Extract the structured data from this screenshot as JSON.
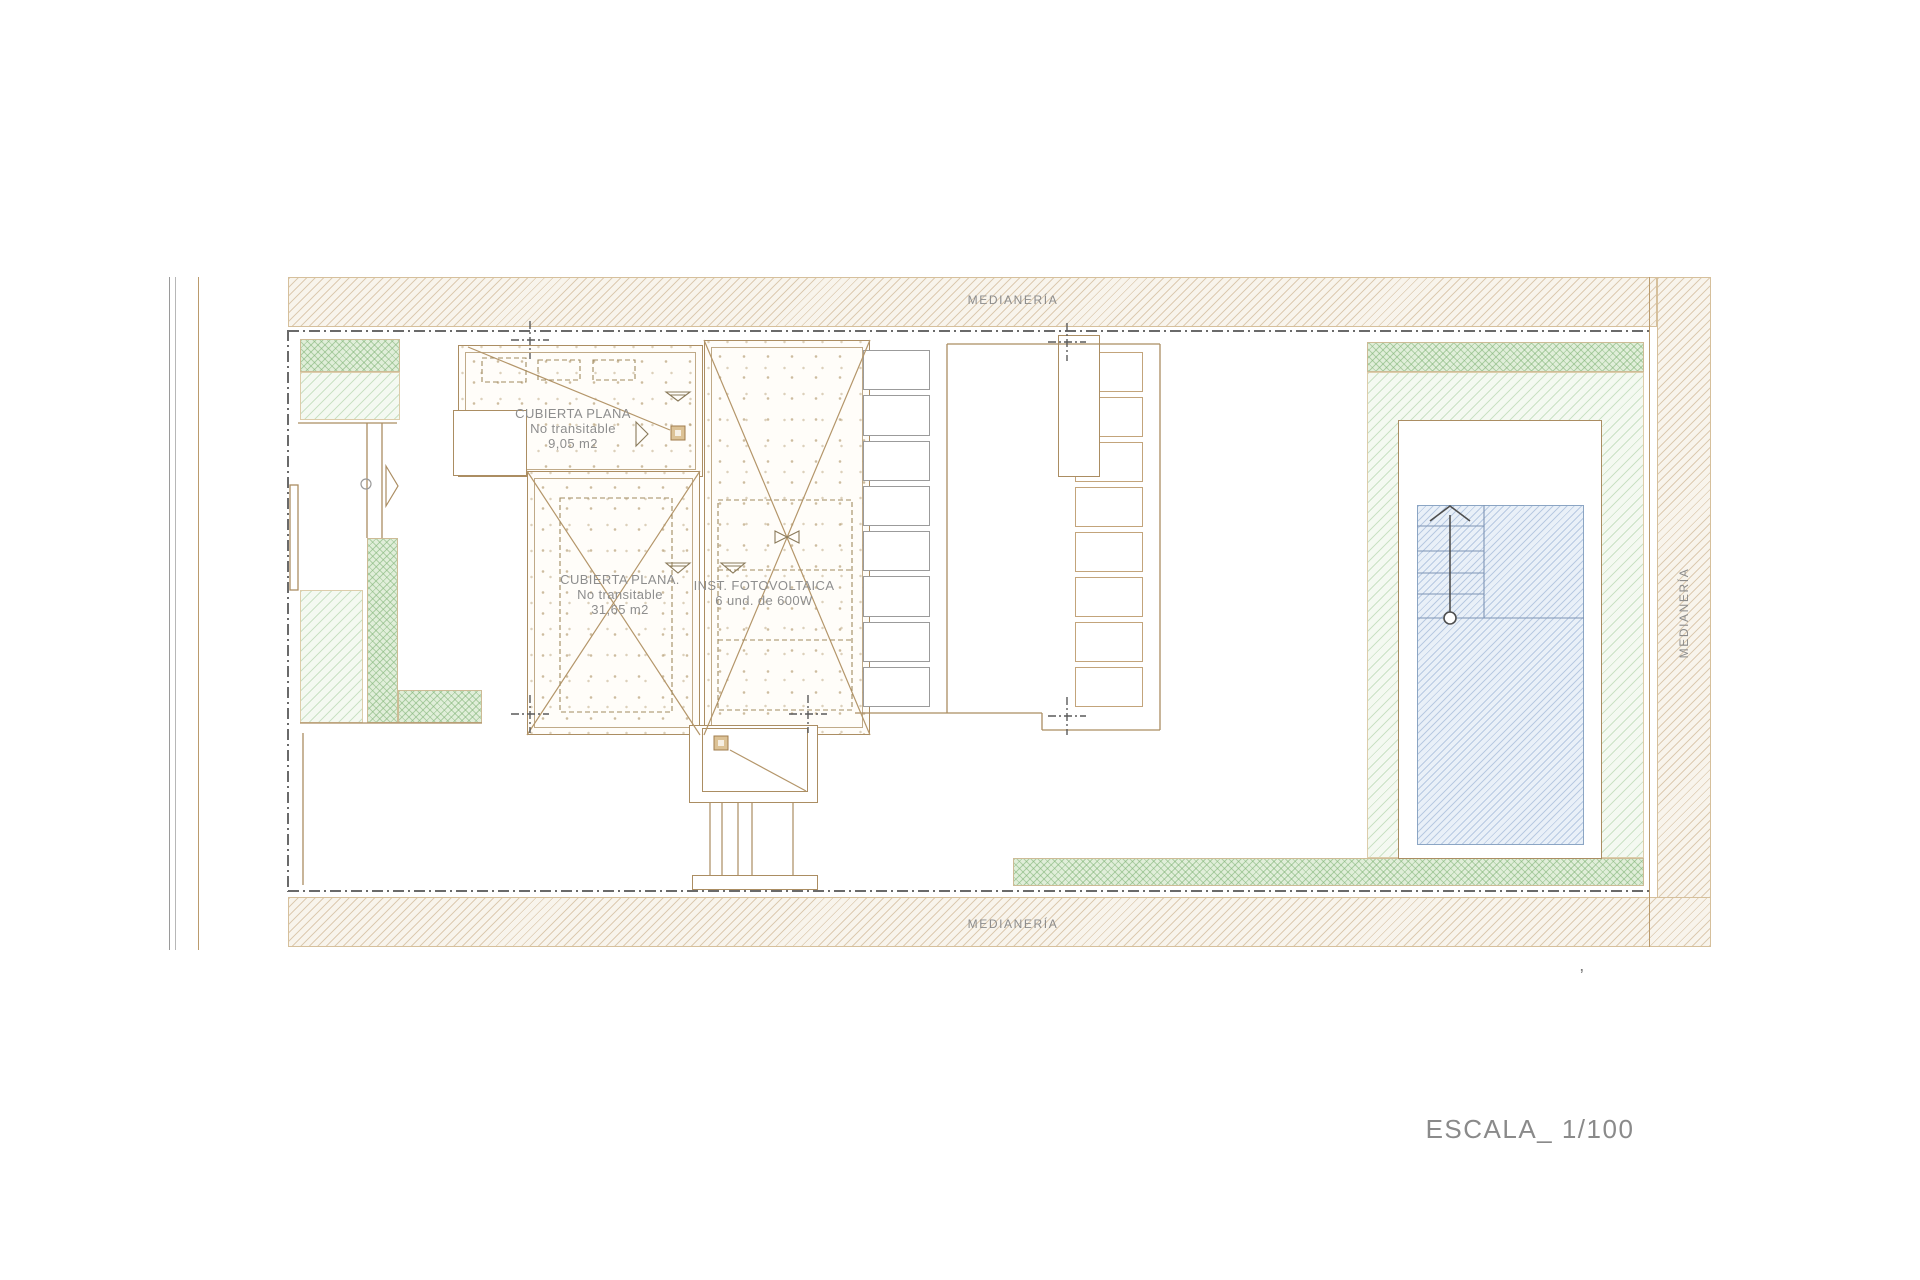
{
  "plan": {
    "boundary_labels": {
      "top": "MEDIANERÍA",
      "bottom": "MEDIANERÍA",
      "right": "MEDIANERÍA"
    },
    "roof_small": {
      "title": "CUBIERTA PLANA",
      "subtitle": "No transitable",
      "area": "9,05 m2"
    },
    "roof_large": {
      "title": "CUBIERTA PLANA.",
      "subtitle": "No transitable",
      "area": "31,65 m2"
    },
    "photovoltaic": {
      "title": "INST. FOTOVOLTAICA",
      "detail": "6 und.  de 600W"
    },
    "scale_label": "ESCALA_ 1/100",
    "stray_mark": "’",
    "colors": {
      "drawing_line_tan": "#ab8d62",
      "party_wall_hatch": "#d6c09c",
      "garden_green": "#9fc793",
      "pool_blue": "#8ba5c4",
      "text_gray": "#8e8e8e",
      "boundary_dashdot": "#6a6a6a"
    },
    "icons": {
      "door_swing": "door-swing-icon",
      "pool_stairs_arrow": "stairs-arrow-icon",
      "level_indicator": "level-indicator-icon",
      "vent": "vent-icon",
      "roof_drain": "roof-drain-square"
    }
  }
}
